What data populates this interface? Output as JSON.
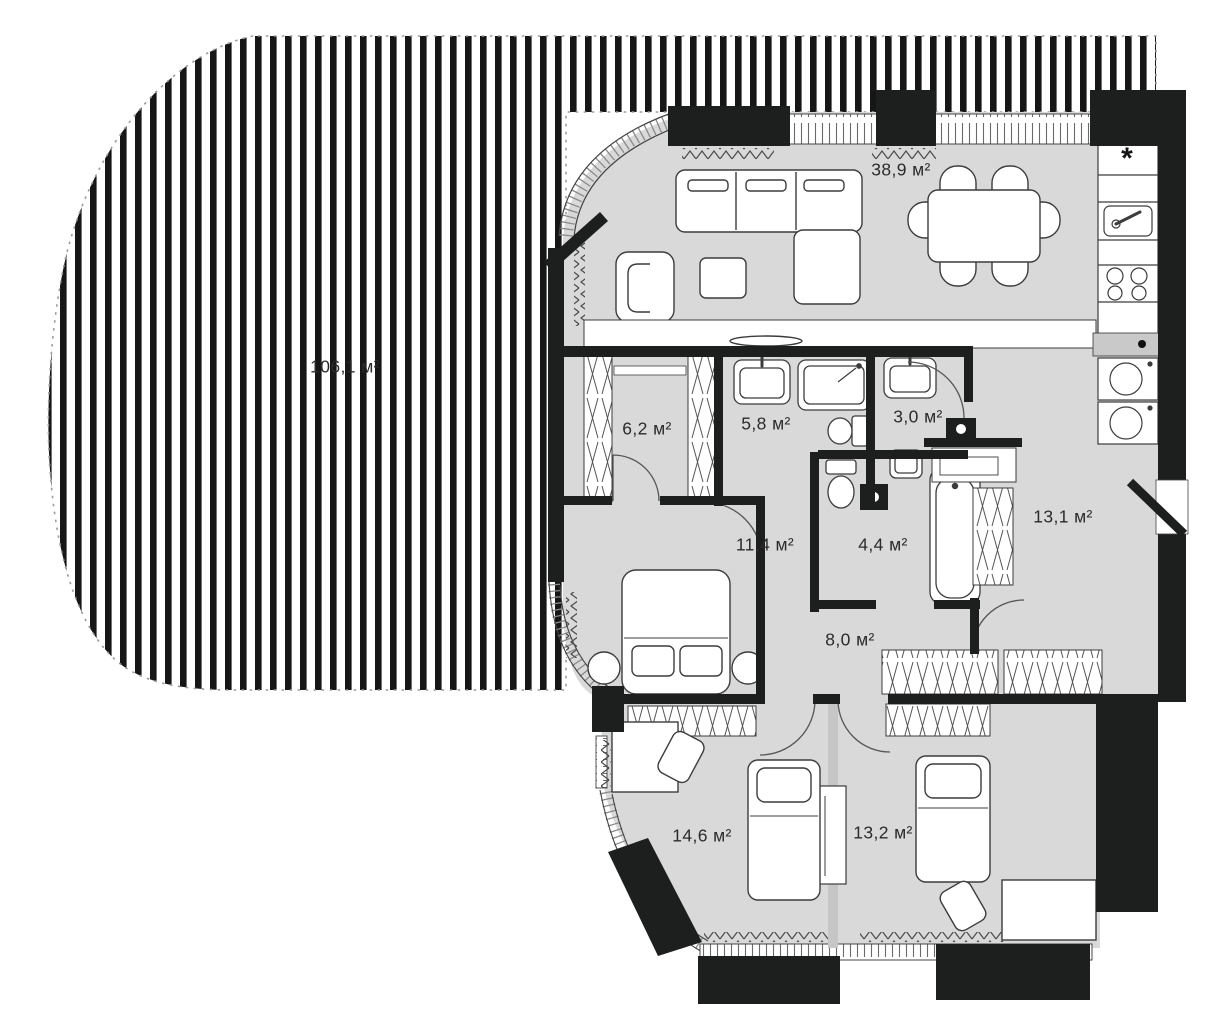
{
  "plan": {
    "unit_suffix": "м²",
    "terrace": {
      "id": "terrace",
      "area": "106,1 м²"
    },
    "rooms": [
      {
        "id": "living-kitchen",
        "area": "38,9 м²"
      },
      {
        "id": "closet",
        "area": "6,2 м²"
      },
      {
        "id": "bathroom-1",
        "area": "5,8 м²"
      },
      {
        "id": "wc",
        "area": "3,0 м²"
      },
      {
        "id": "hallway",
        "area": "13,1 м²"
      },
      {
        "id": "bedroom-1",
        "area": "11,4 м²"
      },
      {
        "id": "bathroom-2",
        "area": "4,4 м²"
      },
      {
        "id": "corridor",
        "area": "8,0 м²"
      },
      {
        "id": "bedroom-2",
        "area": "14,6 м²"
      },
      {
        "id": "bedroom-3",
        "area": "13,2 м²"
      }
    ],
    "symbols": {
      "fridge_asterisk": "*"
    },
    "colors": {
      "background": "#ffffff",
      "floor_fill": "#d9d9d9",
      "wall": "#1d1f1e",
      "terrace_stripe": "#161616",
      "boundary_dash": "#9b9b9b"
    }
  }
}
